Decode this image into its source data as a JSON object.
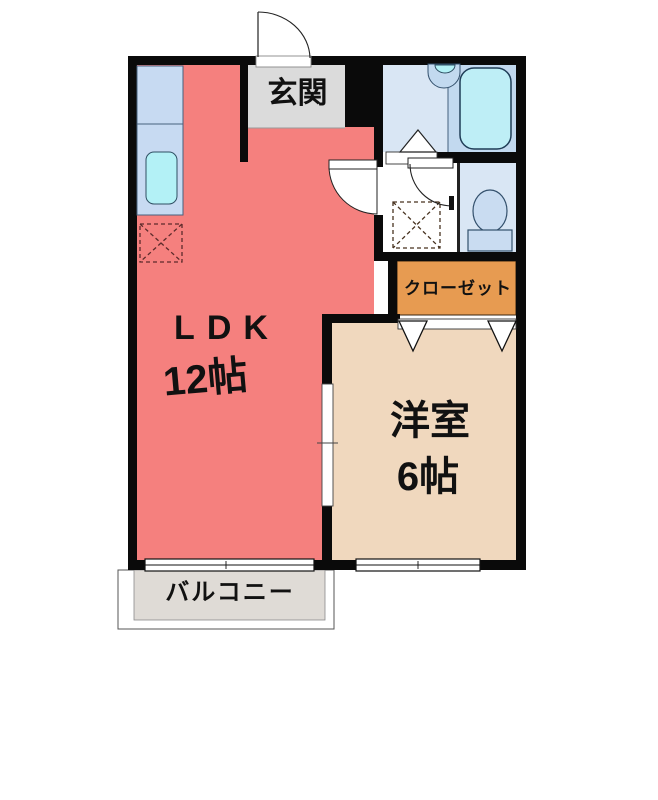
{
  "floorplan": {
    "rooms": {
      "ldk": {
        "name": "LDK",
        "size": "12帖"
      },
      "western_room": {
        "name": "洋室",
        "size": "6帖"
      },
      "entrance": {
        "name": "玄関"
      },
      "closet": {
        "name": "クローゼット"
      },
      "balcony": {
        "name": "バルコニー"
      }
    },
    "fixtures": [
      "kitchen-counter",
      "kitchen-sink",
      "refrigerator-space",
      "bathtub",
      "washbasin",
      "washing-machine-space",
      "toilet"
    ],
    "colors": {
      "wall": "#0a0a0a",
      "ldk": "#F5807E",
      "western_room": "#F0D8BE",
      "closet": "#E79B51",
      "entrance": "#DBDBDB",
      "balcony": "#DFDBD6",
      "kitchen_counter": "#C7DAF2",
      "bathroom": "#D9E6F4",
      "bathroom_inner": "#C2D9EF",
      "bathtub": "#BEEEF6",
      "sink": "#B3F1F6",
      "toilet": "#C9DCF1",
      "background": "#FFFFFF",
      "text": "#111111"
    }
  }
}
